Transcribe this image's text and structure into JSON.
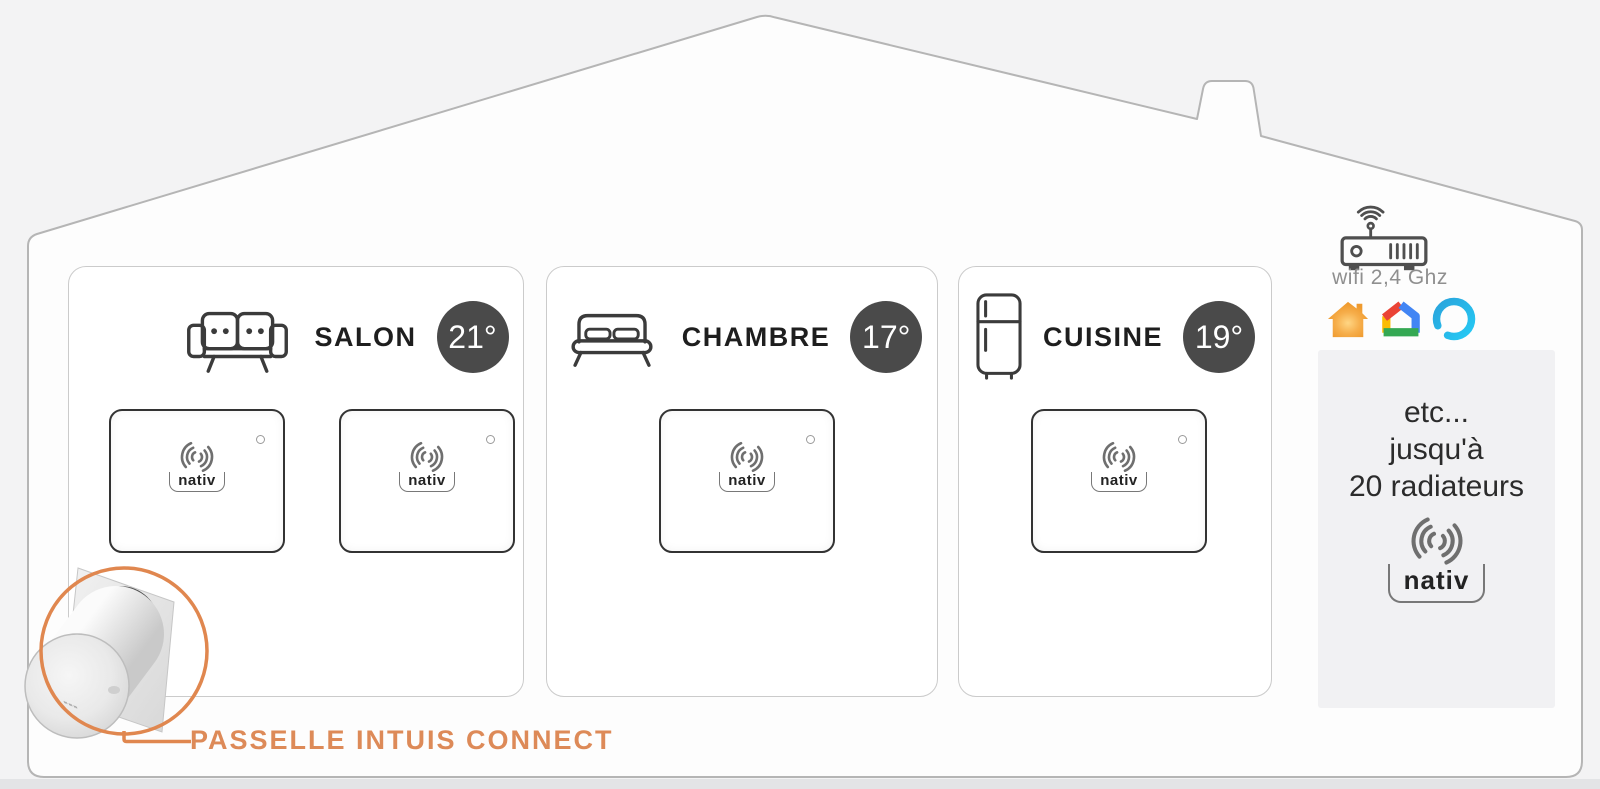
{
  "rooms": [
    {
      "name": "SALON",
      "temperature": "21°",
      "icon": "sofa-icon",
      "device_count": 2
    },
    {
      "name": "CHAMBRE",
      "temperature": "17°",
      "icon": "bed-icon",
      "device_count": 1
    },
    {
      "name": "CUISINE",
      "temperature": "19°",
      "icon": "fridge-icon",
      "device_count": 1
    }
  ],
  "brand": {
    "wordmark": "nativ"
  },
  "network": {
    "wifi_label": "wifi 2,4 Ghz",
    "router_icon": "wifi-router-icon"
  },
  "integrations": {
    "icons": [
      "nativ-home-app-icon",
      "google-home-icon",
      "amazon-alexa-icon"
    ]
  },
  "more_panel": {
    "lines": [
      "etc...",
      "jusqu'à",
      "20 radiateurs"
    ]
  },
  "gateway": {
    "label": "PASSELLE INTUIS CONNECT"
  },
  "colors": {
    "accent_orange": "#DD8A58",
    "temp_badge": "#4A4A4A",
    "house_outline": "#B5B5B5",
    "device_border": "#333333",
    "alexa_blue": "#25C9F4",
    "google_red": "#EA4335",
    "google_blue": "#4285F4",
    "google_yellow": "#FBBC04",
    "google_green": "#34A853",
    "nativ_house_orange": "#F2A13C"
  }
}
